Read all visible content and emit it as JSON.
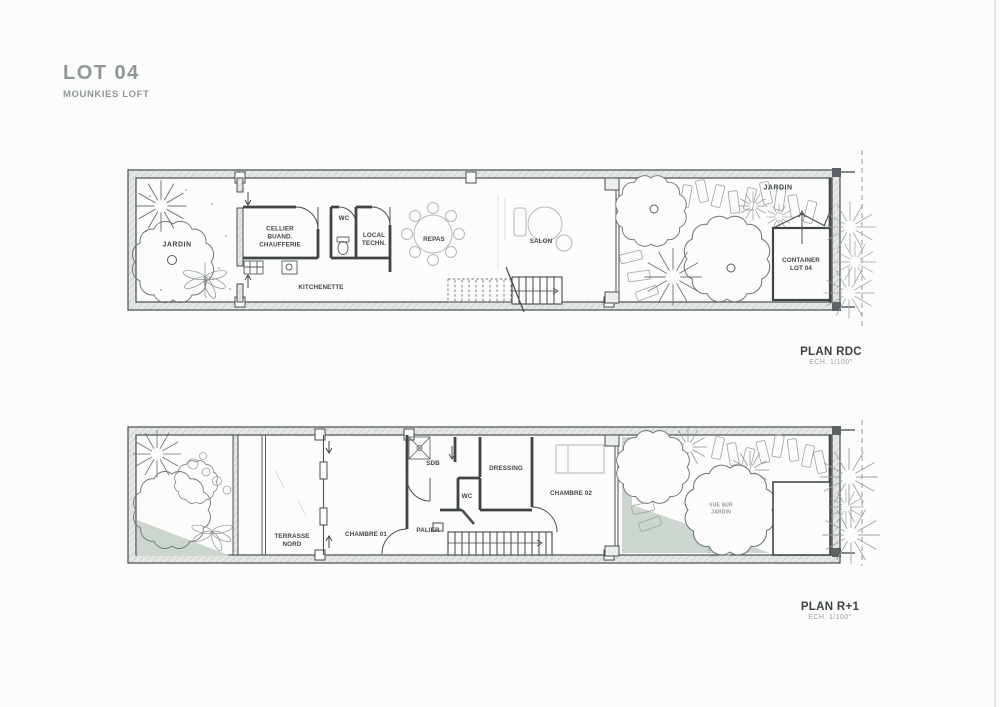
{
  "title": {
    "lot": "LOT 04",
    "project": "MOUNKIES LOFT"
  },
  "colors": {
    "paper": "#fcfcfa",
    "ink": "#454b4e",
    "muted_gray": "#8e969a",
    "sketch_gray": "#b2b9bb",
    "garden_green": "#ccd5ce",
    "wall_fill": "#e4e7e4"
  },
  "plan_rdc": {
    "caption": "PLAN RDC",
    "scale": "ECH. 1/100°",
    "rooms": {
      "jardin_left": "JARDIN",
      "cellier": "CELLIER\nBUAND.\nCHAUFFERIE",
      "wc": "WC",
      "local_tech": "LOCAL\nTECHN.",
      "kitchenette": "KITCHENETTE",
      "repas": "REPAS",
      "salon": "SALON",
      "jardin_right": "JARDIN",
      "container": "CONTAINER\nLOT 04"
    }
  },
  "plan_r1": {
    "caption": "PLAN R+1",
    "scale": "ECH. 1/100°",
    "rooms": {
      "terrasse": "TERRASSE\nNORD",
      "chambre01": "CHAMBRE 01",
      "sdb": "SDB",
      "dressing": "DRESSING",
      "wc": "WC",
      "palier": "PALIER",
      "chambre02": "CHAMBRE 02",
      "vue_jardin": "VUE SUR\nJARDIN"
    }
  }
}
